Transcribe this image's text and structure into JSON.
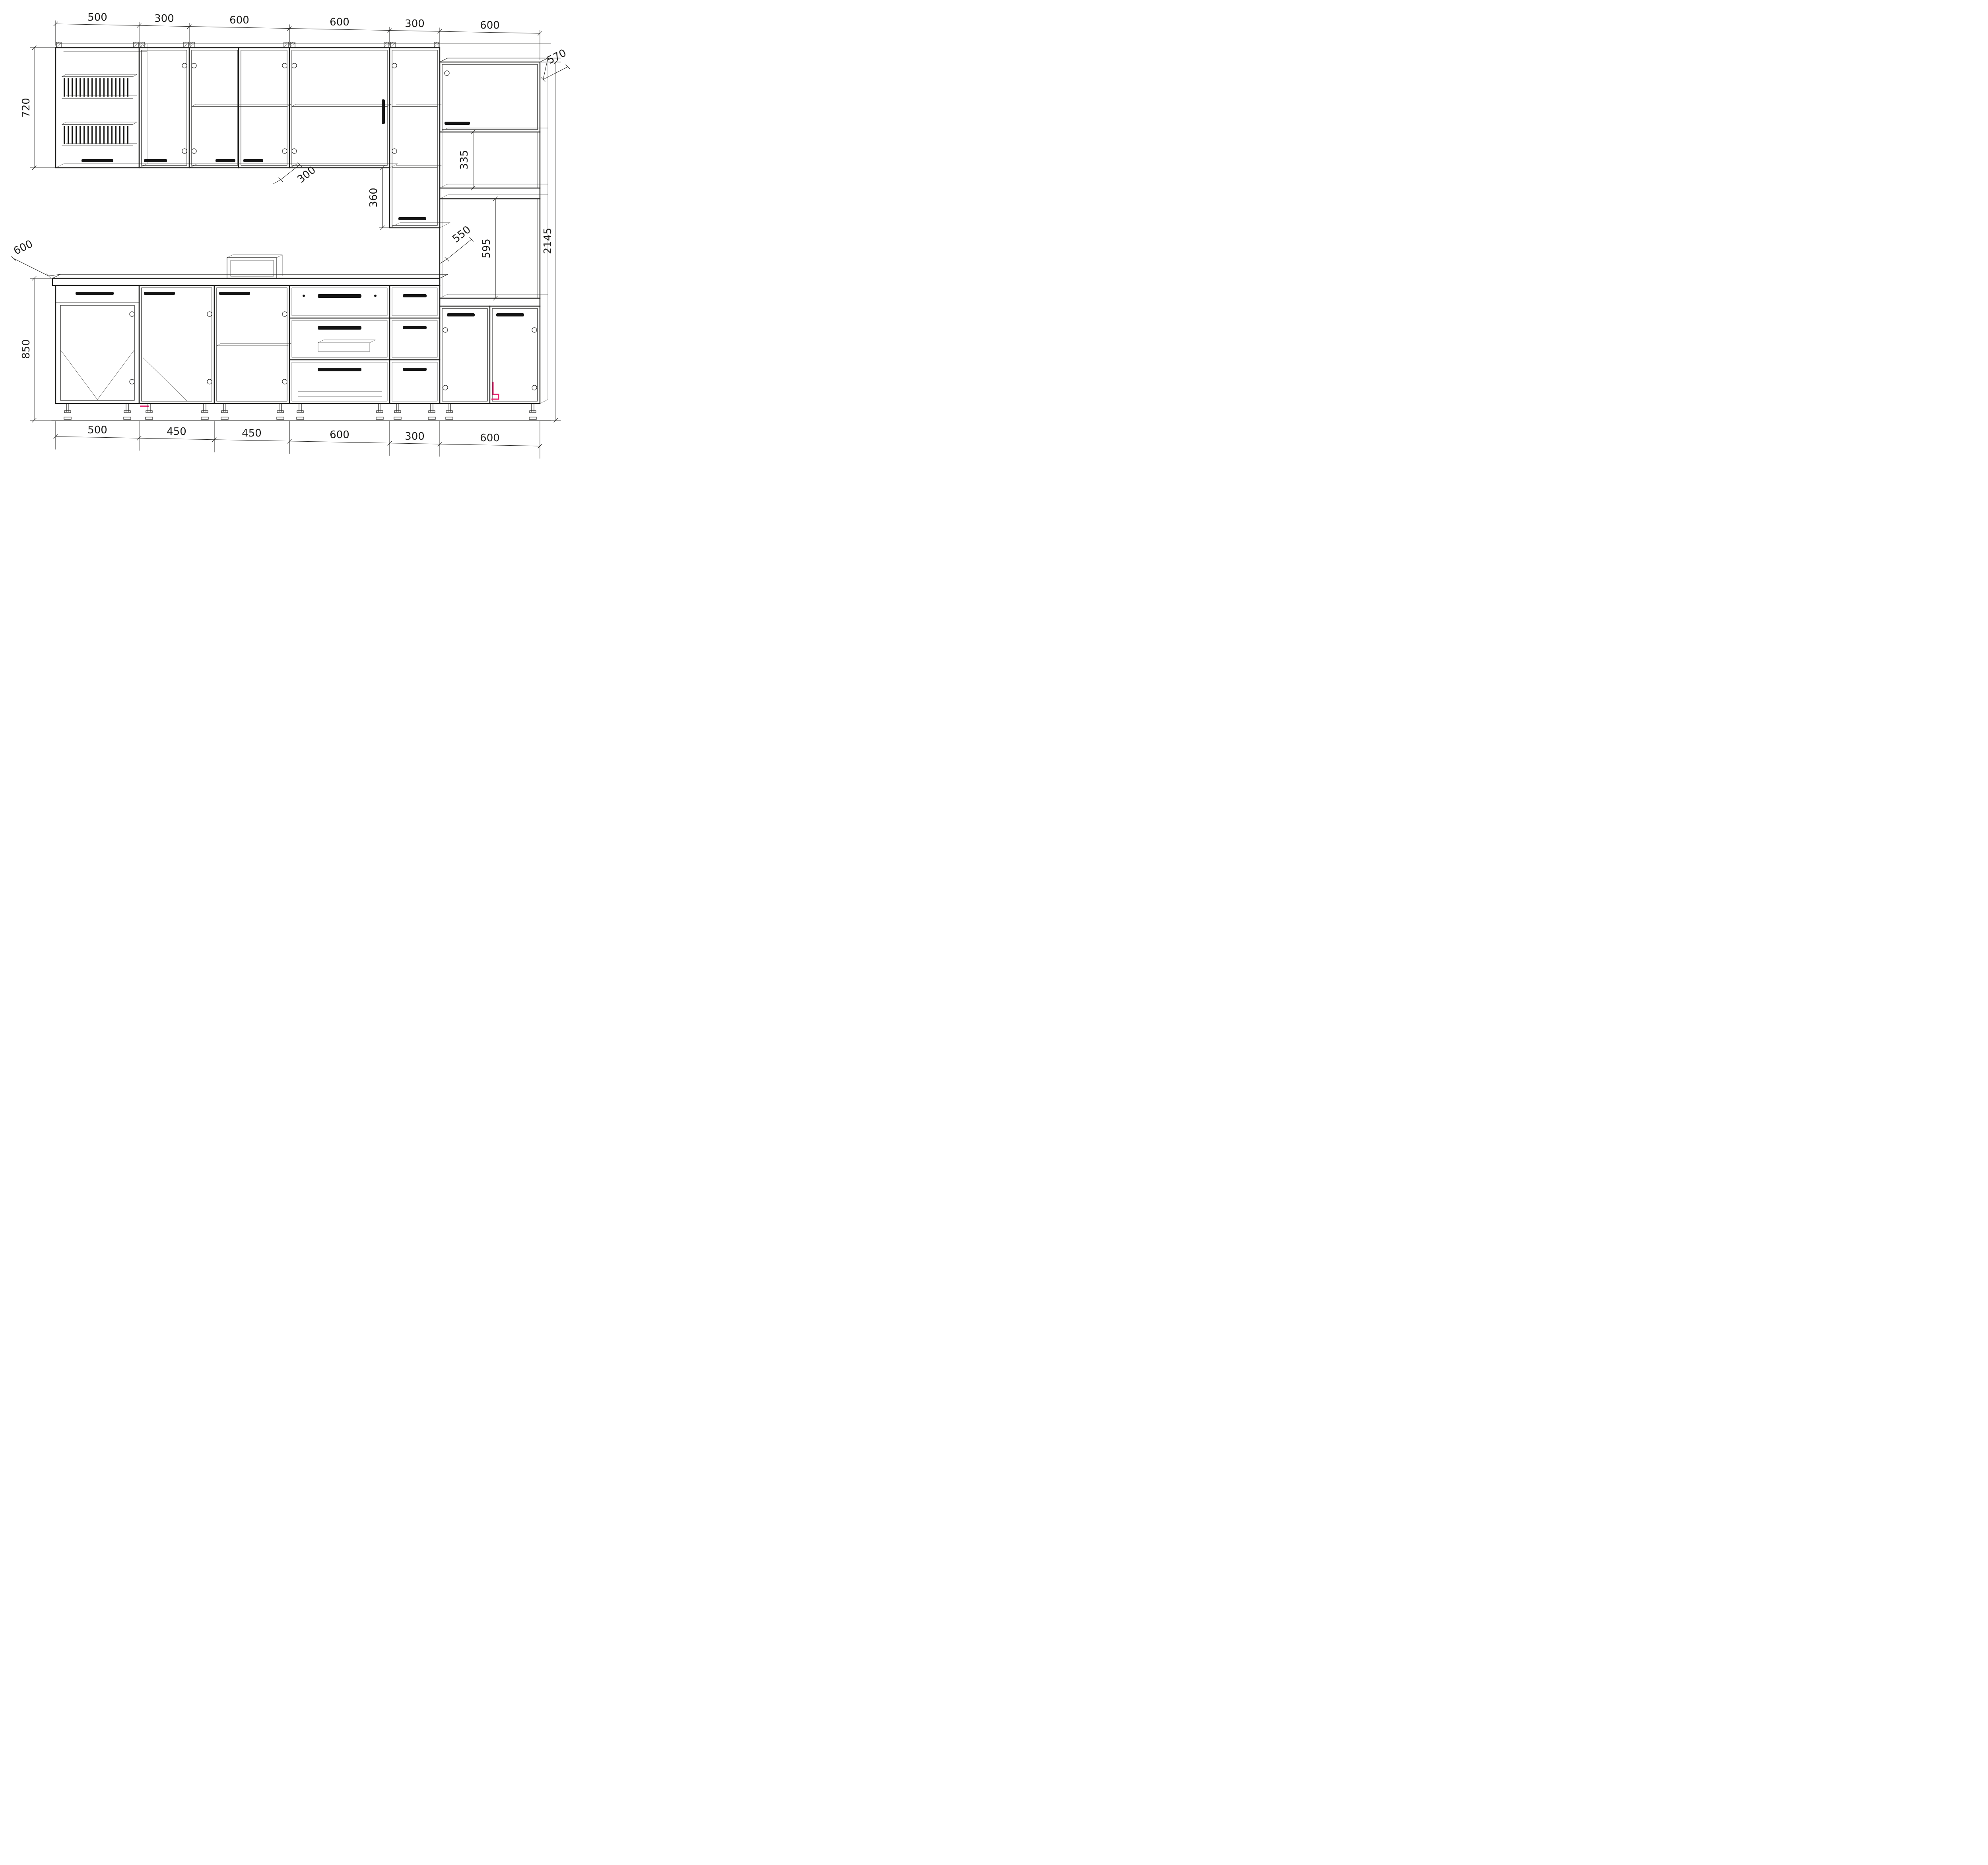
{
  "drawing": {
    "background": "#ffffff",
    "line_color": "#1d1d1b",
    "accent_color": "#e6246f",
    "dims": {
      "top": [
        "500",
        "300",
        "600",
        "600",
        "300",
        "600"
      ],
      "bottom": [
        "500",
        "450",
        "450",
        "600",
        "300",
        "600"
      ],
      "upper_cabinet_height": "720",
      "base_height": "850",
      "base_depth": "600",
      "wall_cabinet_depth": "300",
      "hang_drop": "360",
      "tall_total_height": "2145",
      "tall_depth": "570",
      "upper_niche_height": "335",
      "niche_depth": "550",
      "oven_niche_height": "595"
    }
  }
}
